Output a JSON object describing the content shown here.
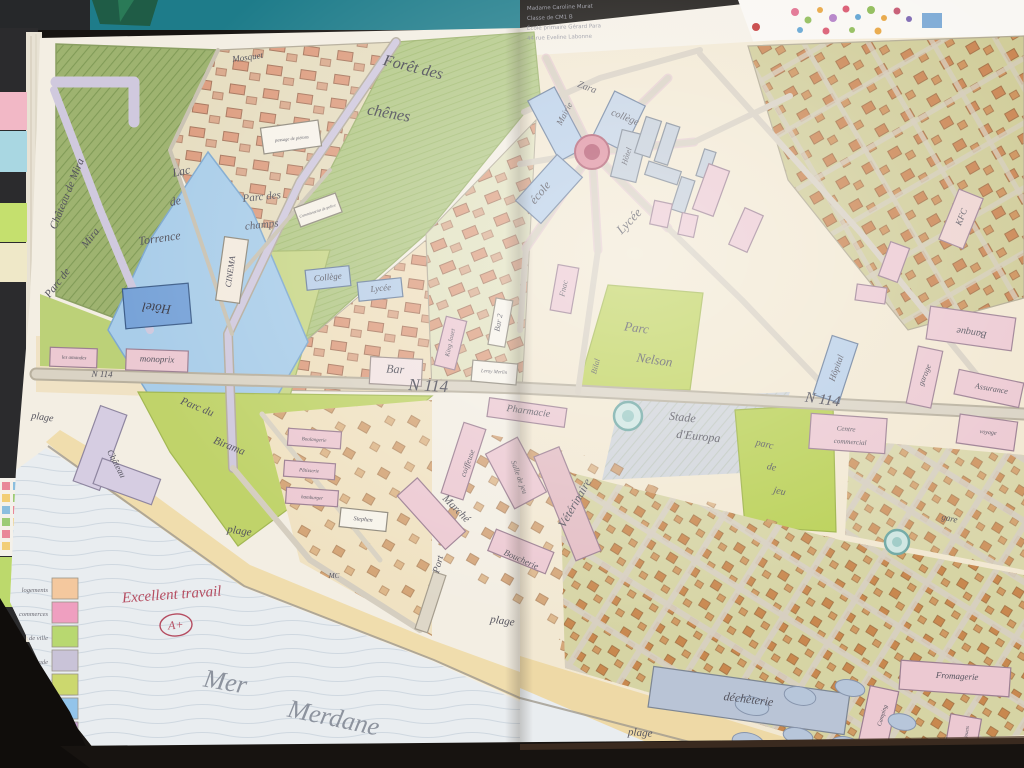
{
  "photo": {
    "description": "notebook double-page with child's hand-drawn city map",
    "teacher_note": {
      "text": "Excellent travail",
      "grade": "A+",
      "color": "#b54c60"
    },
    "sea": {
      "word1": "Mer",
      "word2": "Merdane"
    }
  },
  "paper_note": {
    "lines": [
      "Madame Caroline Murat",
      "Classe de CM1 B",
      "École primaire Gérard Para",
      "44 rue Eveline Labonne"
    ]
  },
  "legend": {
    "items": [
      {
        "label": "logements",
        "color": "#f4c89e"
      },
      {
        "label": "commerces",
        "color": "#ef9fc0"
      },
      {
        "label": "zone de ville",
        "color": "#b8d870"
      },
      {
        "label": "stade",
        "color": "#c9c3d8"
      },
      {
        "label": "bois",
        "color": "#ccd86e"
      },
      {
        "label": "mer",
        "color": "#93c4ea"
      },
      {
        "label": "routes",
        "color": "#c8a4d4"
      }
    ]
  },
  "palette": {
    "forest_dark": "#9eb370",
    "forest_light": "#b9cc84",
    "park_green": "#c0d36a",
    "lake_blue": "#a9cde9",
    "road_lavender": "#d0c9de",
    "road_gray": "#d6cfc0",
    "building_pink": "#ecc9d2",
    "building_blue": "#b9cfe8",
    "building_salmon": "#dc9678",
    "sea": "#e9edf0",
    "sand": "#f0ddad",
    "pencil": "#55545e",
    "teal_band": "#1e7c8a"
  },
  "map_labels": [
    {
      "id": "chateau-de-mira",
      "t": "Château de Mira",
      "x": 70,
      "y": 195,
      "r": -68,
      "s": 11
    },
    {
      "id": "mosquet",
      "t": "Mosquet",
      "x": 248,
      "y": 60,
      "r": -8,
      "s": 9
    },
    {
      "id": "foret-des",
      "t": "Forêt des",
      "x": 412,
      "y": 72,
      "r": 14,
      "s": 16,
      "c": "#43424e"
    },
    {
      "id": "foret-chenes",
      "t": "chênes",
      "x": 388,
      "y": 118,
      "r": 10,
      "s": 16,
      "c": "#43424e"
    },
    {
      "id": "lac",
      "t": "Lac",
      "x": 182,
      "y": 175,
      "r": -12,
      "s": 12
    },
    {
      "id": "lac-de",
      "t": "de",
      "x": 176,
      "y": 205,
      "r": -12,
      "s": 12
    },
    {
      "id": "lac-torrence",
      "t": "Torrence",
      "x": 160,
      "y": 242,
      "r": -8,
      "s": 12
    },
    {
      "id": "parc-champs-1",
      "t": "Parc des",
      "x": 262,
      "y": 200,
      "r": -6,
      "s": 11
    },
    {
      "id": "parc-champs-2",
      "t": "champs",
      "x": 262,
      "y": 228,
      "r": -6,
      "s": 11
    },
    {
      "id": "passage-label",
      "t": "passage de piétons",
      "x": 292,
      "y": 140,
      "r": -6,
      "s": 4.5
    },
    {
      "id": "commissariat-label",
      "t": "Commissariat de police",
      "x": 318,
      "y": 212,
      "r": -18,
      "s": 4
    },
    {
      "id": "cinema-label",
      "t": "CINEMA",
      "x": 233,
      "y": 272,
      "r": -82,
      "s": 8.5,
      "c": "#4a4956"
    },
    {
      "id": "college-left",
      "t": "Collège",
      "x": 328,
      "y": 280,
      "r": -6,
      "s": 9
    },
    {
      "id": "lycee-left",
      "t": "Lycée",
      "x": 381,
      "y": 291,
      "r": -6,
      "s": 9
    },
    {
      "id": "hotel-left",
      "t": "Hôtel",
      "x": 157,
      "y": 304,
      "r": 186,
      "s": 13,
      "c": "#3c3b46"
    },
    {
      "id": "parc-mira-1",
      "t": "Parc de",
      "x": 60,
      "y": 285,
      "r": -52,
      "s": 11
    },
    {
      "id": "parc-mira-2",
      "t": "Mira",
      "x": 93,
      "y": 240,
      "r": -52,
      "s": 11
    },
    {
      "id": "monoprix",
      "t": "monoprix",
      "x": 157,
      "y": 362,
      "r": 2,
      "s": 9
    },
    {
      "id": "amandes",
      "t": "les amandes",
      "x": 74,
      "y": 359,
      "r": 2,
      "s": 5
    },
    {
      "id": "n114-left",
      "t": "N 114",
      "x": 102,
      "y": 377,
      "r": 2,
      "s": 9
    },
    {
      "id": "n114-center",
      "t": "N 114",
      "x": 428,
      "y": 391,
      "r": 3,
      "s": 17,
      "c": "#4a4955"
    },
    {
      "id": "bar",
      "t": "Bar",
      "x": 395,
      "y": 373,
      "r": 3,
      "s": 12
    },
    {
      "id": "king-jouet",
      "t": "King Jouet",
      "x": 452,
      "y": 343,
      "r": -78,
      "s": 6.5
    },
    {
      "id": "bar-2",
      "t": "Bar 2",
      "x": 501,
      "y": 323,
      "r": -80,
      "s": 8
    },
    {
      "id": "leroy-merlin",
      "t": "Leroy Merlin",
      "x": 494,
      "y": 373,
      "r": 4,
      "s": 5
    },
    {
      "id": "ecole-right",
      "t": "école",
      "x": 543,
      "y": 195,
      "r": -50,
      "s": 12
    },
    {
      "id": "pharmacie",
      "t": "Pharmacie",
      "x": 528,
      "y": 414,
      "r": 8,
      "s": 10
    },
    {
      "id": "coiffeuse",
      "t": "coiffeuse",
      "x": 470,
      "y": 464,
      "r": -70,
      "s": 8
    },
    {
      "id": "salle-de-jeu",
      "t": "Salle de jeu",
      "x": 517,
      "y": 478,
      "r": 70,
      "s": 7.5
    },
    {
      "id": "marche",
      "t": "Marché",
      "x": 454,
      "y": 511,
      "r": 45,
      "s": 11
    },
    {
      "id": "veterinaire",
      "t": "Vétérinaire",
      "x": 578,
      "y": 505,
      "r": -60,
      "s": 12
    },
    {
      "id": "boucherie",
      "t": "Boucherie",
      "x": 520,
      "y": 562,
      "r": 24,
      "s": 9
    },
    {
      "id": "mc",
      "t": "MC",
      "x": 334,
      "y": 578,
      "r": 0,
      "s": 7
    },
    {
      "id": "boulangerie",
      "t": "Boulangerie",
      "x": 314,
      "y": 441,
      "r": 4,
      "s": 5
    },
    {
      "id": "patisserie",
      "t": "Pâtisserie",
      "x": 309,
      "y": 472,
      "r": 4,
      "s": 5
    },
    {
      "id": "hamburger",
      "t": "hamburger",
      "x": 312,
      "y": 499,
      "r": 4,
      "s": 5
    },
    {
      "id": "stephen",
      "t": "Stephen",
      "x": 363,
      "y": 521,
      "r": 5,
      "s": 6
    },
    {
      "id": "port",
      "t": "Port",
      "x": 441,
      "y": 565,
      "r": -75,
      "s": 10
    },
    {
      "id": "parc-birama-1",
      "t": "Parc du",
      "x": 196,
      "y": 410,
      "r": 22,
      "s": 11
    },
    {
      "id": "parc-birama-2",
      "t": "Birama",
      "x": 228,
      "y": 449,
      "r": 22,
      "s": 11
    },
    {
      "id": "chateau-2",
      "t": "Château",
      "x": 114,
      "y": 465,
      "r": 62,
      "s": 9
    },
    {
      "id": "plage-1",
      "t": "plage",
      "x": 42,
      "y": 420,
      "r": 8,
      "s": 10
    },
    {
      "id": "plage-2",
      "t": "plage",
      "x": 239,
      "y": 534,
      "r": 8,
      "s": 11
    },
    {
      "id": "plage-3",
      "t": "plage",
      "x": 502,
      "y": 624,
      "r": 8,
      "s": 11
    },
    {
      "id": "plage-4",
      "t": "plage",
      "x": 640,
      "y": 736,
      "r": 4,
      "s": 11
    },
    {
      "id": "zara",
      "t": "Zara",
      "x": 586,
      "y": 90,
      "r": 20,
      "s": 10
    },
    {
      "id": "mairie",
      "t": "Mairie",
      "x": 567,
      "y": 115,
      "r": -62,
      "s": 9
    },
    {
      "id": "college-right",
      "t": "collège",
      "x": 624,
      "y": 120,
      "r": 22,
      "s": 10
    },
    {
      "id": "hotel-right",
      "t": "Hôtel",
      "x": 629,
      "y": 157,
      "r": -72,
      "s": 8
    },
    {
      "id": "lycee-right",
      "t": "Lycée",
      "x": 632,
      "y": 224,
      "r": -46,
      "s": 13
    },
    {
      "id": "fnac",
      "t": "Fnac",
      "x": 566,
      "y": 289,
      "r": -78,
      "s": 8
    },
    {
      "id": "bilal",
      "t": "Bilal",
      "x": 598,
      "y": 367,
      "r": -75,
      "s": 8
    },
    {
      "id": "parc-nelson-1",
      "t": "Parc",
      "x": 636,
      "y": 332,
      "r": 8,
      "s": 13
    },
    {
      "id": "parc-nelson-2",
      "t": "Nelson",
      "x": 654,
      "y": 364,
      "r": 8,
      "s": 13
    },
    {
      "id": "kfc",
      "t": "KFC",
      "x": 964,
      "y": 218,
      "r": -68,
      "s": 9
    },
    {
      "id": "banque",
      "t": "Banque",
      "x": 972,
      "y": 330,
      "r": 188,
      "s": 10
    },
    {
      "id": "hopital",
      "t": "Hôpital",
      "x": 839,
      "y": 369,
      "r": -70,
      "s": 9
    },
    {
      "id": "garage",
      "t": "garage",
      "x": 927,
      "y": 376,
      "r": -68,
      "s": 8
    },
    {
      "id": "assurance",
      "t": "Assurance",
      "x": 991,
      "y": 391,
      "r": 10,
      "s": 8
    },
    {
      "id": "n114-right",
      "t": "N 114",
      "x": 822,
      "y": 404,
      "r": 8,
      "s": 15,
      "c": "#4a4955"
    },
    {
      "id": "centre-commercial-1",
      "t": "Centre",
      "x": 846,
      "y": 431,
      "r": 4,
      "s": 7
    },
    {
      "id": "centre-commercial-2",
      "t": "commercial",
      "x": 850,
      "y": 444,
      "r": 4,
      "s": 7
    },
    {
      "id": "voyage",
      "t": "voyage",
      "x": 988,
      "y": 434,
      "r": 6,
      "s": 6
    },
    {
      "id": "stade-1",
      "t": "Stade",
      "x": 682,
      "y": 421,
      "r": 6,
      "s": 12
    },
    {
      "id": "stade-2",
      "t": "d'Europa",
      "x": 698,
      "y": 440,
      "r": 6,
      "s": 12
    },
    {
      "id": "parc-jeu-1",
      "t": "parc",
      "x": 764,
      "y": 447,
      "r": 12,
      "s": 10
    },
    {
      "id": "parc-jeu-2",
      "t": "de",
      "x": 771,
      "y": 470,
      "r": 12,
      "s": 10
    },
    {
      "id": "parc-jeu-3",
      "t": "jeu",
      "x": 779,
      "y": 494,
      "r": 12,
      "s": 10
    },
    {
      "id": "gare",
      "t": "gare",
      "x": 949,
      "y": 521,
      "r": 12,
      "s": 9
    },
    {
      "id": "fromagerie",
      "t": "Fromagerie",
      "x": 957,
      "y": 679,
      "r": 3,
      "s": 9
    },
    {
      "id": "dechetterie",
      "t": "déchèterie",
      "x": 748,
      "y": 703,
      "r": 7,
      "s": 12
    },
    {
      "id": "bassin-1",
      "t": "Bassin",
      "x": 813,
      "y": 748,
      "r": 4,
      "s": 8
    },
    {
      "id": "bassin-2",
      "t": "d'épuration",
      "x": 820,
      "y": 761,
      "r": 4,
      "s": 8
    },
    {
      "id": "magasin-jouets",
      "t": "magasin de jouets",
      "x": 966,
      "y": 744,
      "r": -80,
      "s": 5
    },
    {
      "id": "camping",
      "t": "Camping",
      "x": 884,
      "y": 716,
      "r": -72,
      "s": 6
    }
  ]
}
